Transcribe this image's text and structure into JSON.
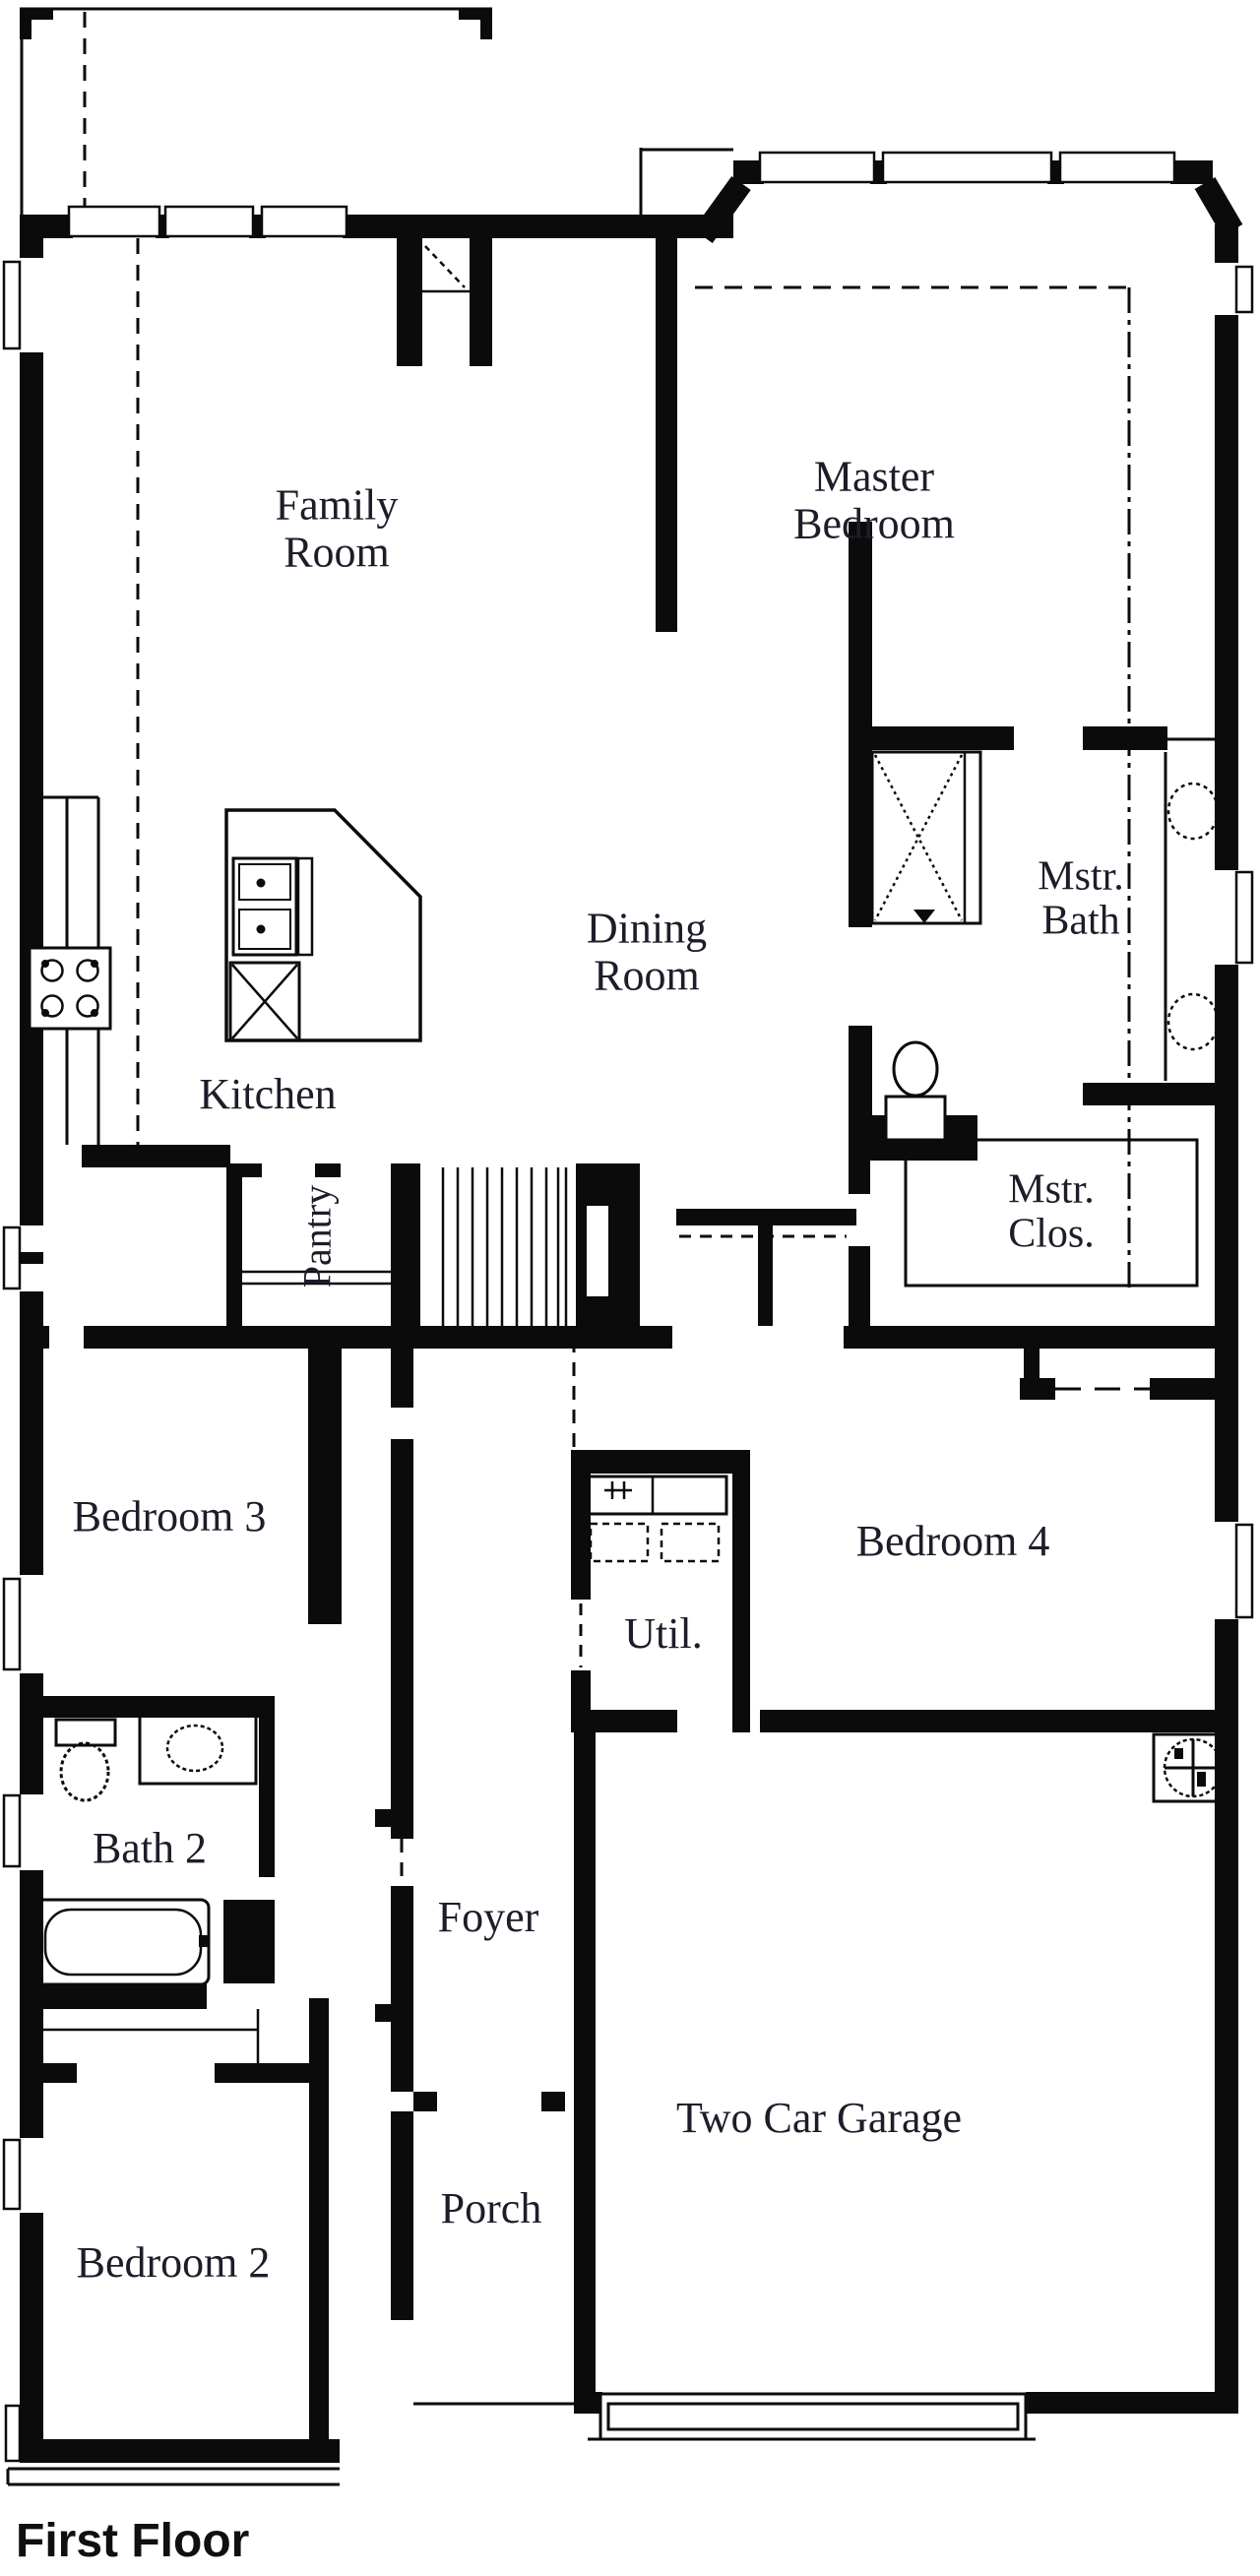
{
  "title": "First Floor",
  "colors": {
    "wall": "#0b0b0b",
    "label": "#1d1d2a",
    "background": "#ffffff"
  },
  "rooms": {
    "family_room": {
      "label": "Family\nRoom"
    },
    "master_bedroom": {
      "label": "Master\nBedroom"
    },
    "dining_room": {
      "label": "Dining\nRoom"
    },
    "kitchen": {
      "label": "Kitchen"
    },
    "pantry": {
      "label": "Pantry"
    },
    "master_bath": {
      "label": "Mstr.\nBath"
    },
    "master_closet": {
      "label": "Mstr.\nClos."
    },
    "bedroom_3": {
      "label": "Bedroom 3"
    },
    "utility": {
      "label": "Util."
    },
    "bedroom_4": {
      "label": "Bedroom 4"
    },
    "bath_2": {
      "label": "Bath 2"
    },
    "foyer": {
      "label": "Foyer"
    },
    "bedroom_2": {
      "label": "Bedroom 2"
    },
    "porch": {
      "label": "Porch"
    },
    "garage": {
      "label": "Two Car Garage"
    }
  },
  "fixtures": [
    "covered-patio",
    "windows",
    "corner-fireplace",
    "cooktop",
    "kitchen-counter",
    "kitchen-island",
    "range-oven",
    "island-sink",
    "stairs",
    "pantry-shelves",
    "shower",
    "toilet",
    "double-vanity-sinks",
    "closet-shelving",
    "washer-dryer",
    "water-heater",
    "bathtub",
    "bath2-toilet",
    "bath2-sink",
    "front-door-opening",
    "garage-door",
    "tray-ceiling-dashes",
    "plumbing-centerline"
  ]
}
